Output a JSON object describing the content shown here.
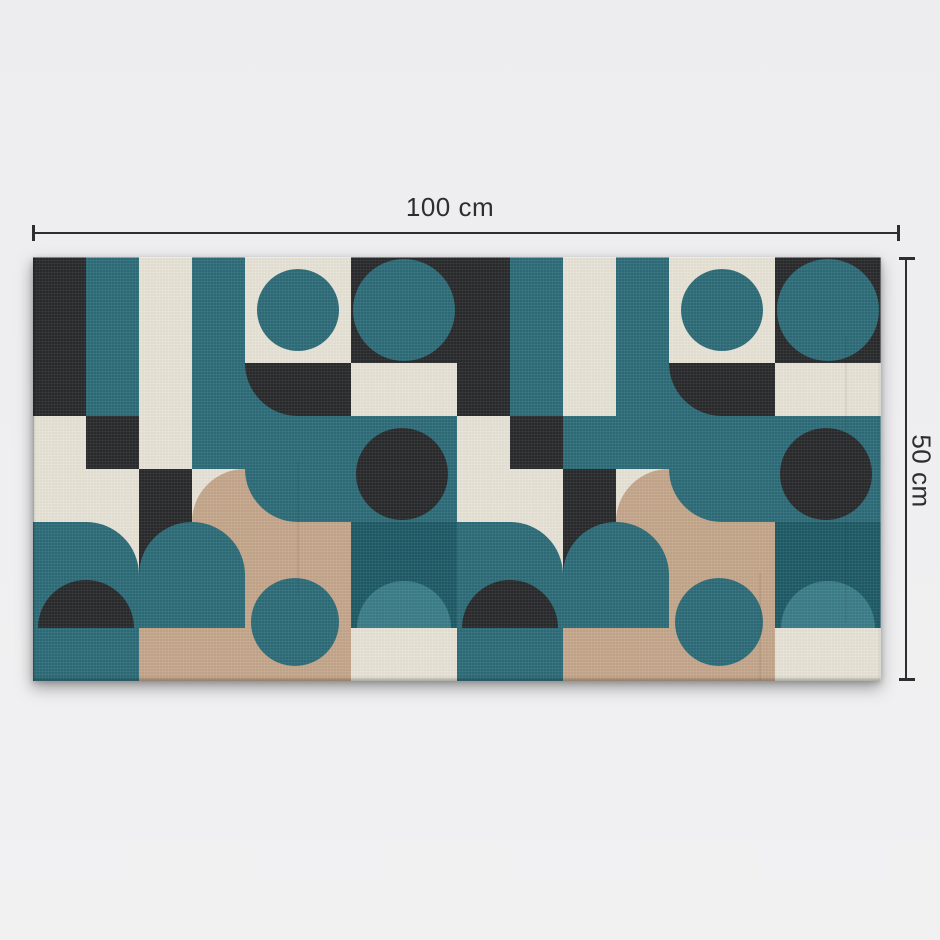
{
  "annotations": {
    "width_label": "100 cm",
    "height_label": "50 cm"
  },
  "artwork": {
    "style": "bauhaus-geometric-pattern",
    "surface": "canvas-print"
  },
  "palette": {
    "background": "#efeff1",
    "annotation_color": "#2e2e30",
    "canvas_black": "#2a2b2d",
    "canvas_teal": "#2e6d79",
    "canvas_teal_dark": "#1f5b67",
    "canvas_teal_light": "#3b7e89",
    "canvas_cream": "#e8e3d7",
    "canvas_tan": "#c5a78c"
  }
}
